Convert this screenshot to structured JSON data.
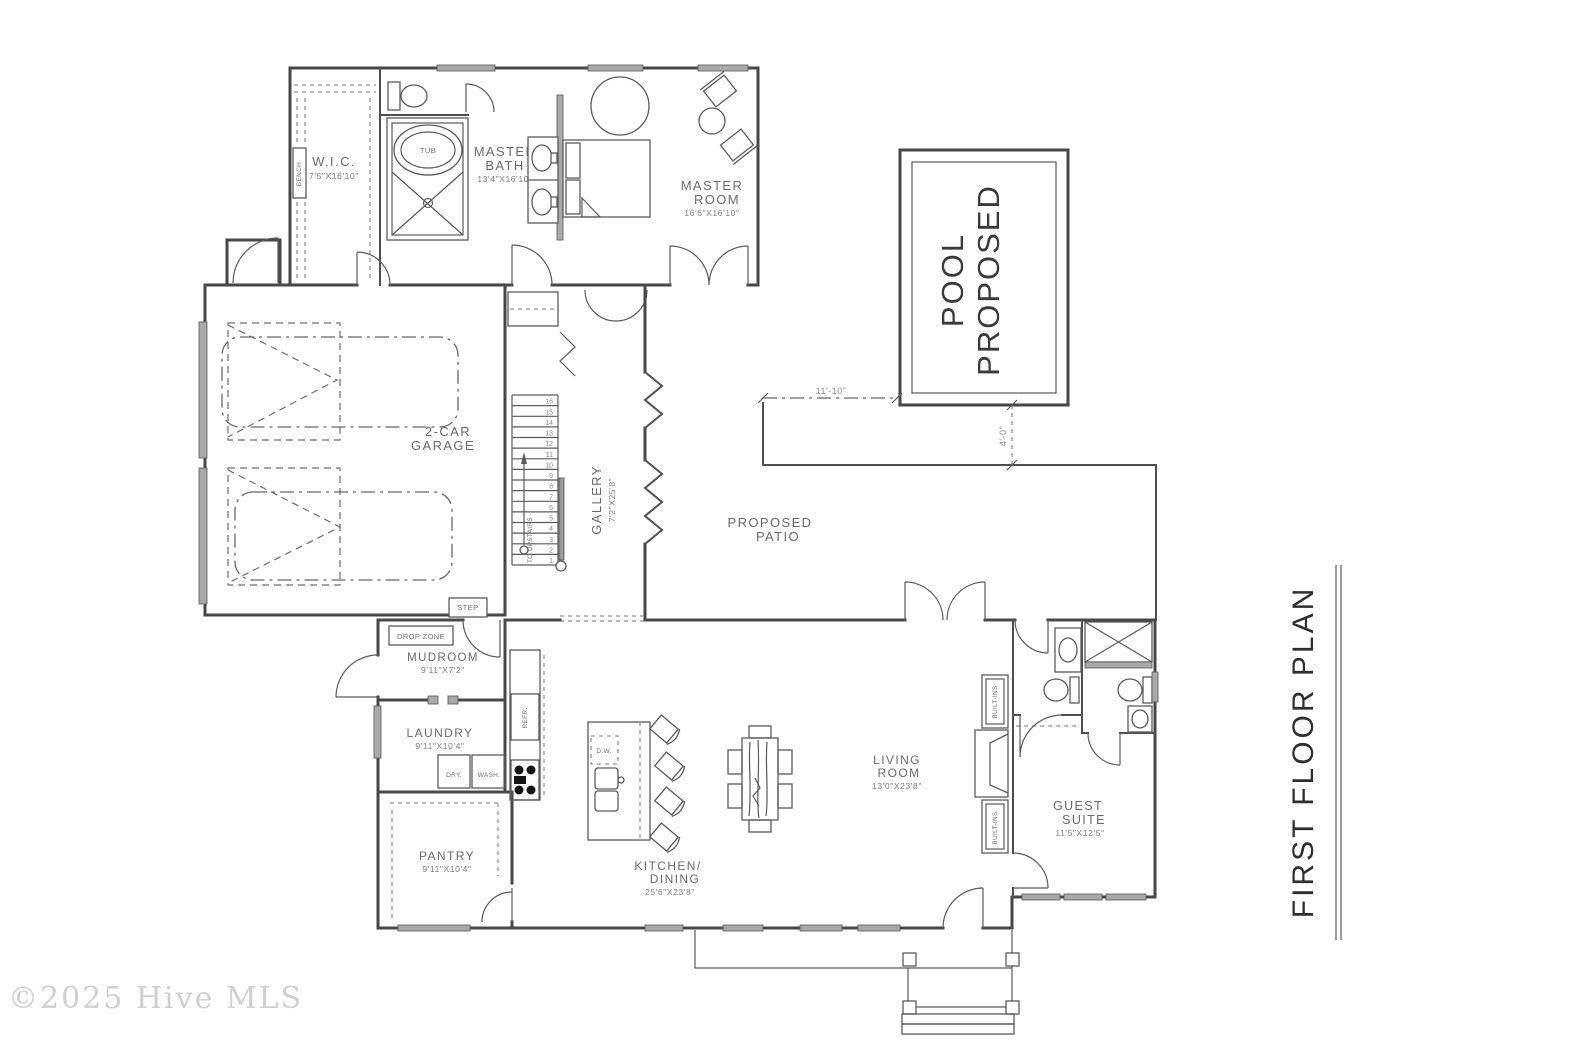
{
  "watermark": "©2025 Hive MLS",
  "sheet_title": "FIRST  FLOOR PLAN",
  "rooms": {
    "wic": {
      "line1": "W.I.C.",
      "dims": "7'5\"X16'10\""
    },
    "master_bath": {
      "line1": "MASTER",
      "line2": "BATH",
      "dims": "13'4\"X16'10\""
    },
    "master_room": {
      "line1": "MASTER",
      "line2": "ROOM",
      "dims": "16'6\"X16'10\""
    },
    "garage": {
      "line1": "2-CAR",
      "line2": "GARAGE"
    },
    "gallery": {
      "line1": "GALLERY",
      "dims": "7'2\"X25'8\""
    },
    "pool": {
      "line1": "POOL",
      "line2": "PROPOSED"
    },
    "patio": {
      "line1": "PROPOSED",
      "line2": "PATIO"
    },
    "mudroom": {
      "line1": "MUDROOM",
      "dims": "9'11\"X7'2\""
    },
    "laundry": {
      "line1": "LAUNDRY",
      "dims": "9'11\"X10'4\""
    },
    "pantry": {
      "line1": "PANTRY",
      "dims": "9'11\"X10'4\""
    },
    "kitchen_dining": {
      "line1": "KITCHEN/",
      "line2": "DINING",
      "dims": "25'6\"X23'8\""
    },
    "living_room": {
      "line1": "LIVING",
      "line2": "ROOM",
      "dims": "13'0\"X23'8\""
    },
    "guest_suite": {
      "line1": "GUEST",
      "line2": "SUITE",
      "dims": "11'5\"X12'5\""
    }
  },
  "labels": {
    "bench": "BENCH",
    "tub": "TUB",
    "step": "STEP",
    "drop_zone": "DROP ZONE",
    "dryer": "DRY.",
    "washer": "WASH.",
    "refrigerator": "REFR.",
    "dishwasher": "D.W.",
    "built_ins_upper": "BUILT-INS",
    "built_ins_lower": "BUILT-INS",
    "to_upstairs": "TO UPSTAIRS"
  },
  "dimensions": {
    "patio_width": "11'-10\"",
    "pool_offset": "4'-0\""
  },
  "stairs": {
    "numbers": [
      "1",
      "2",
      "3",
      "4",
      "5",
      "6",
      "7",
      "8",
      "9",
      "10",
      "11",
      "12",
      "13",
      "14",
      "15",
      "16"
    ]
  },
  "colors": {
    "wall": "#474747",
    "label": "#6a6a6a",
    "window": "#a9a9a9",
    "watermark": "#cfcfcf"
  }
}
